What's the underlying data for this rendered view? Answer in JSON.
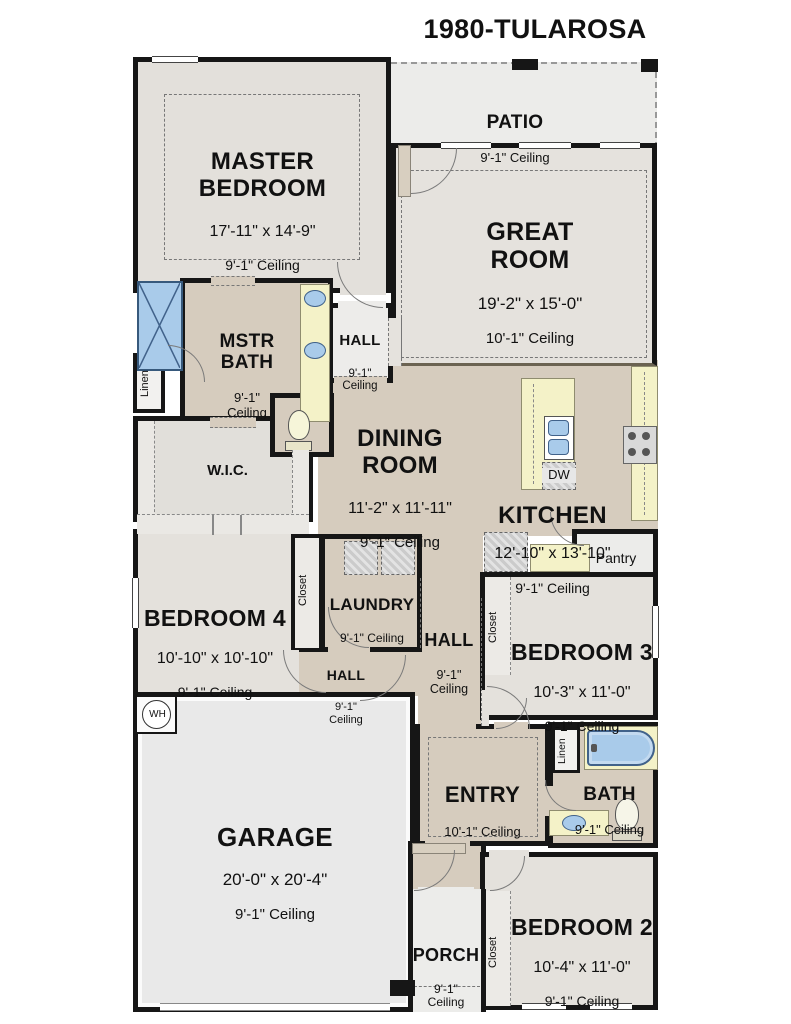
{
  "title": "1980-TULAROSA",
  "colors": {
    "wall": "#161616",
    "tan_floor": "#d6ccbe",
    "gray_floor": "#e4e1dc",
    "patio_floor": "#ececea",
    "counter_yellow": "#f4f2c8",
    "fixture_blue": "#a9cbea",
    "great_room_divider": "#6b6352"
  },
  "rooms": {
    "master_bedroom": {
      "name": "MASTER\nBEDROOM",
      "dims": "17'-11\" x 14'-9\"",
      "ceiling": "9'-1\" Ceiling"
    },
    "patio": {
      "name": "PATIO",
      "ceiling": "9'-1\" Ceiling"
    },
    "great_room": {
      "name": "GREAT\nROOM",
      "dims": "19'-2\" x 15'-0\"",
      "ceiling": "10'-1\" Ceiling"
    },
    "mstr_bath": {
      "name": "MSTR\nBATH",
      "ceiling": "9'-1\"\nCeiling"
    },
    "hall_upper": {
      "name": "HALL",
      "ceiling": "9'-1\"\nCeiling"
    },
    "linen_master": {
      "name": "Linen"
    },
    "wic": {
      "name": "W.I.C."
    },
    "dining_room": {
      "name": "DINING\nROOM",
      "dims": "11'-2\" x 11'-11\"",
      "ceiling": "9'-1\" Ceiling"
    },
    "kitchen": {
      "name": "KITCHEN",
      "dims": "12'-10\" x 13'-10\"",
      "ceiling": "9'-1\" Ceiling"
    },
    "pantry": {
      "name": "Pantry"
    },
    "dishwasher": {
      "name": "DW"
    },
    "bedroom4": {
      "name": "BEDROOM 4",
      "dims": "10'-10\" x 10'-10\"",
      "ceiling": "9'-1\" Ceiling"
    },
    "closet_b4": {
      "name": "Closet"
    },
    "laundry": {
      "name": "LAUNDRY",
      "ceiling": "9'-1\" Ceiling"
    },
    "hall_b4": {
      "name": "HALL",
      "ceiling": "9'-1\"\nCeiling"
    },
    "hall_main": {
      "name": "HALL",
      "ceiling": "9'-1\"\nCeiling"
    },
    "bedroom3": {
      "name": "BEDROOM 3",
      "dims": "10'-3\" x 11'-0\"",
      "ceiling": "9'-1\" Ceiling"
    },
    "closet_b3": {
      "name": "Closet"
    },
    "garage": {
      "name": "GARAGE",
      "dims": "20'-0\" x 20'-4\"",
      "ceiling": "9'-1\" Ceiling"
    },
    "water_heater": {
      "name": "WH"
    },
    "entry": {
      "name": "ENTRY",
      "ceiling": "10'-1\" Ceiling"
    },
    "linen_bath": {
      "name": "Linen"
    },
    "bath": {
      "name": "BATH",
      "ceiling": "9'-1\" Ceiling"
    },
    "bedroom2": {
      "name": "BEDROOM 2",
      "dims": "10'-4\" x 11'-0\"",
      "ceiling": "9'-1\" Ceiling"
    },
    "closet_b2": {
      "name": "Closet"
    },
    "porch": {
      "name": "PORCH",
      "ceiling": "9'-1\"\nCeiling"
    }
  }
}
